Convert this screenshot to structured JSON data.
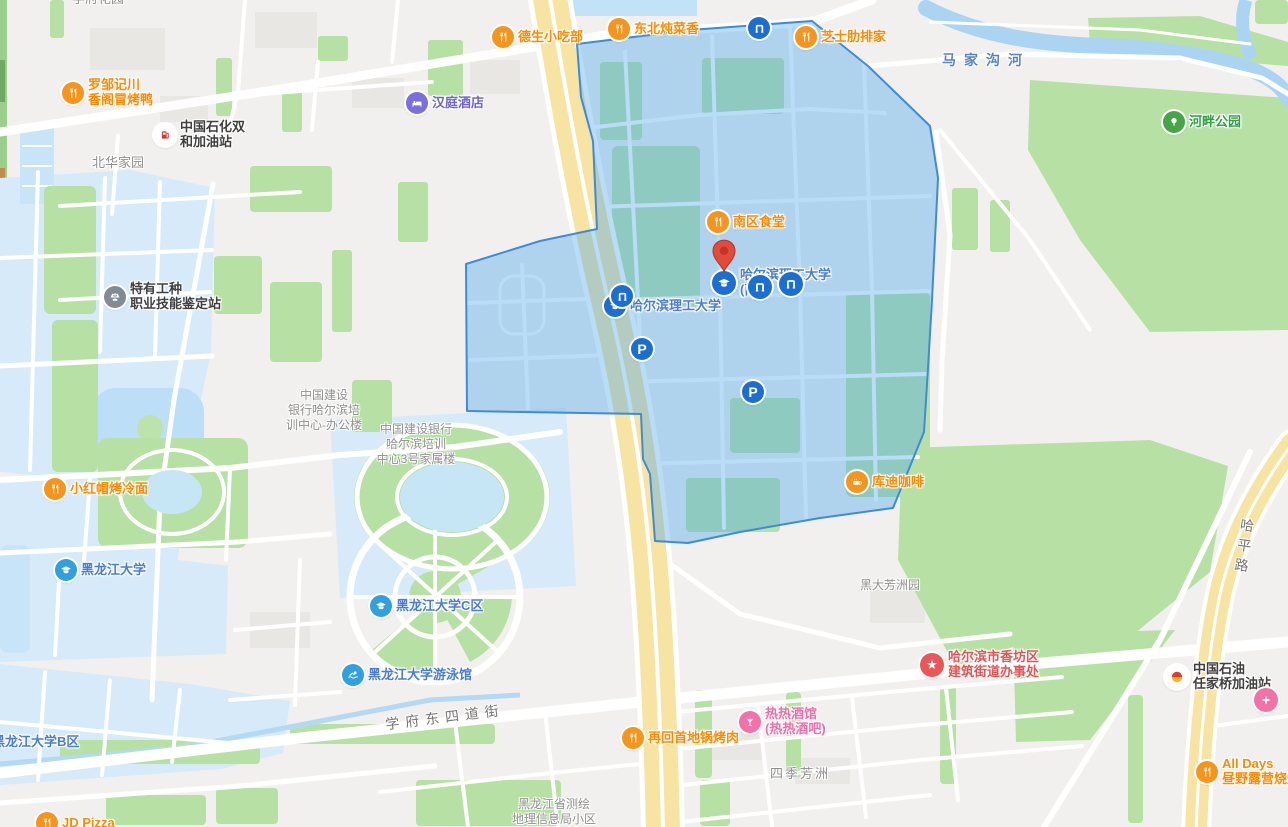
{
  "colors": {
    "campus_highlight_fill": "rgba(80,168,235,0.40)",
    "campus_highlight_border": "#3E8BD8",
    "secondary_campus_fill": "#D7EAF9",
    "road_yellow": "#F7E3A2",
    "green_area": "#B7E1A4",
    "water": "#ABD4F2",
    "poi_orange": "#F6951D",
    "poi_blue": "#1C6FD1"
  },
  "road_labels": {
    "majiagou_river": "马家沟河",
    "haping_road": "哈平路",
    "xuefu_dongsidao_street": "学府东四道街"
  },
  "pois": {
    "xuefu_garden": {
      "l1": "学府花园"
    },
    "luozou": {
      "l1": "罗邹记川",
      "l2": "香阁冒烤鸭"
    },
    "sinopec": {
      "l1": "中国石化双",
      "l2": "和加油站"
    },
    "beihua": {
      "l1": "北华家园"
    },
    "hanting": {
      "l1": "汉庭酒店"
    },
    "desheng": {
      "l1": "德生小吃部"
    },
    "dongbei": {
      "l1": "东北炖菜香"
    },
    "zhishi": {
      "l1": "芝士肋排家"
    },
    "hepan": {
      "l1": "河畔公园"
    },
    "teyou": {
      "l1": "特有工种",
      "l2": "职业技能鉴定站"
    },
    "nanqu": {
      "l1": "南区食堂"
    },
    "hust_south": {
      "l1": "哈尔滨理工大学",
      "l2": "(南"
    },
    "hust": {
      "l1": "哈尔滨理工大学"
    },
    "p_label": "P",
    "ccb_office": {
      "l1": "中国建设",
      "l2": "银行哈尔滨培",
      "l3": "训中心-办公楼"
    },
    "ccb_dorm": {
      "l1": "中国建设银行",
      "l2": "哈尔滨培训",
      "l3": "中心3号家属楼"
    },
    "xiaohongmao": {
      "l1": "小红帽烤冷面"
    },
    "kudi": {
      "l1": "库迪咖啡"
    },
    "heida_fangzhou": {
      "l1": "黑大芳洲园"
    },
    "hlju": {
      "l1": "黑龙江大学"
    },
    "hlju_c": {
      "l1": "黑龙江大学C区"
    },
    "hlju_swim": {
      "l1": "黑龙江大学游泳馆"
    },
    "hlju_b": {
      "l1": "黑龙江大学B区"
    },
    "gov": {
      "l1": "哈尔滨市香坊区",
      "l2": "建筑街道办事处"
    },
    "petrochina": {
      "l1": "中国石油",
      "l2": "任家桥加油站"
    },
    "alldays": {
      "l1": "All Days",
      "l2": "昼野露营烧烤"
    },
    "rehui": {
      "l1": "再回首地锅烤肉"
    },
    "rere": {
      "l1": "热热酒馆",
      "l2": "(热热酒吧)"
    },
    "siji": {
      "l1": "四季芳洲"
    },
    "cehui": {
      "l1": "黑龙江省测绘",
      "l2": "地理信息局小区"
    },
    "jdpizza": {
      "l1": "JD Pizza"
    }
  }
}
